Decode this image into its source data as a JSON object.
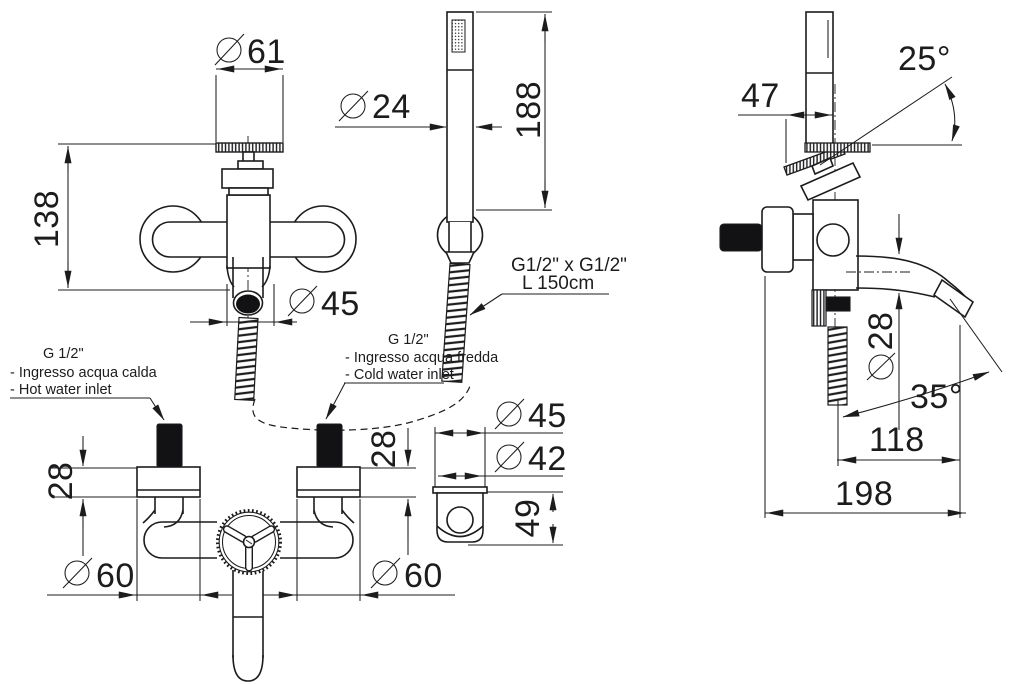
{
  "page": {
    "background": "#ffffff",
    "ink": "#1c1c1e"
  },
  "dimensions": {
    "front": {
      "handle_diameter": {
        "symbol": "Ø",
        "value": "61"
      },
      "height": "138",
      "body_diameter": {
        "symbol": "Ø",
        "value": "45"
      }
    },
    "hand_shower": {
      "handle_diameter": {
        "symbol": "Ø",
        "value": "24"
      },
      "handle_length": "188",
      "hose_thread": "G1/2\" x G1/2\"",
      "hose_length": "L 150cm"
    },
    "bottom": {
      "left_escutcheon_depth": "28",
      "right_escutcheon_depth": "28",
      "left_escutcheon_diameter": {
        "symbol": "Ø",
        "value": "60"
      },
      "right_escutcheon_diameter": {
        "symbol": "Ø",
        "value": "60"
      }
    },
    "holder": {
      "outer_diameter": {
        "symbol": "Ø",
        "value": "45"
      },
      "inner_diameter": {
        "symbol": "Ø",
        "value": "42"
      },
      "height": "49"
    },
    "side": {
      "handle_offset": "47",
      "handle_angle": "25°",
      "spout_diameter": {
        "symbol": "Ø",
        "value": "28"
      },
      "spout_angle": "35°",
      "spout_reach": "118",
      "total_depth": "198"
    }
  },
  "annotations": {
    "hot_inlet": {
      "color": "#e8464b",
      "thread": "G 1/2\"",
      "label_it": "- Ingresso acqua calda",
      "label_en": "- Hot water inlet"
    },
    "cold_inlet": {
      "color": "#3d3dcc",
      "thread": "G 1/2\"",
      "label_it": "- Ingresso acqua fredda",
      "label_en": "- Cold water inlet"
    }
  }
}
